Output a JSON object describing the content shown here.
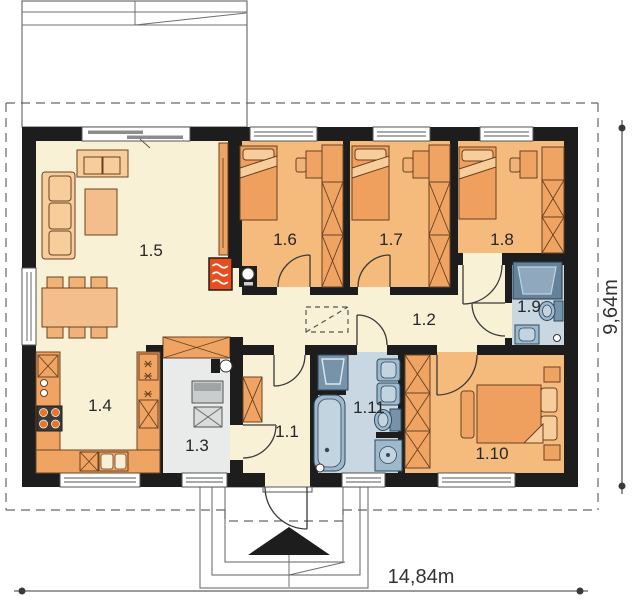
{
  "plan": {
    "rooms": [
      {
        "id": "1.1",
        "label": "1.1"
      },
      {
        "id": "1.2",
        "label": "1.2"
      },
      {
        "id": "1.3",
        "label": "1.3"
      },
      {
        "id": "1.4",
        "label": "1.4"
      },
      {
        "id": "1.5",
        "label": "1.5"
      },
      {
        "id": "1.6",
        "label": "1.6"
      },
      {
        "id": "1.7",
        "label": "1.7"
      },
      {
        "id": "1.8",
        "label": "1.8"
      },
      {
        "id": "1.9",
        "label": "1.9"
      },
      {
        "id": "1.10",
        "label": "1.10"
      },
      {
        "id": "1.11",
        "label": "1.11"
      }
    ],
    "dimensions": {
      "width_label": "14,84m",
      "height_label": "9,64m"
    }
  },
  "colors": {
    "wall": "#1D1D1D",
    "floor_cream": "#F8F1D6",
    "bedroom_orange": "#F5BB7D",
    "bath_blue": "#C8D7E2",
    "utility_gray": "#E9EBEB",
    "furniture_orange": "#EFA05F",
    "furniture_light": "#F7CD9C",
    "counter_orange": "#F0A463",
    "table_orange": "#F3BE8B",
    "chair_orange": "#F0B277",
    "fixture_blue": "#9FB9CC",
    "fixture_light": "#C2D4E0",
    "fixture_dark": "#7793A9",
    "washer_blue": "#64829A",
    "appliance_gray": "#C9CDCD",
    "fireplace_red": "#E84E1B",
    "line_gray": "#707070"
  }
}
